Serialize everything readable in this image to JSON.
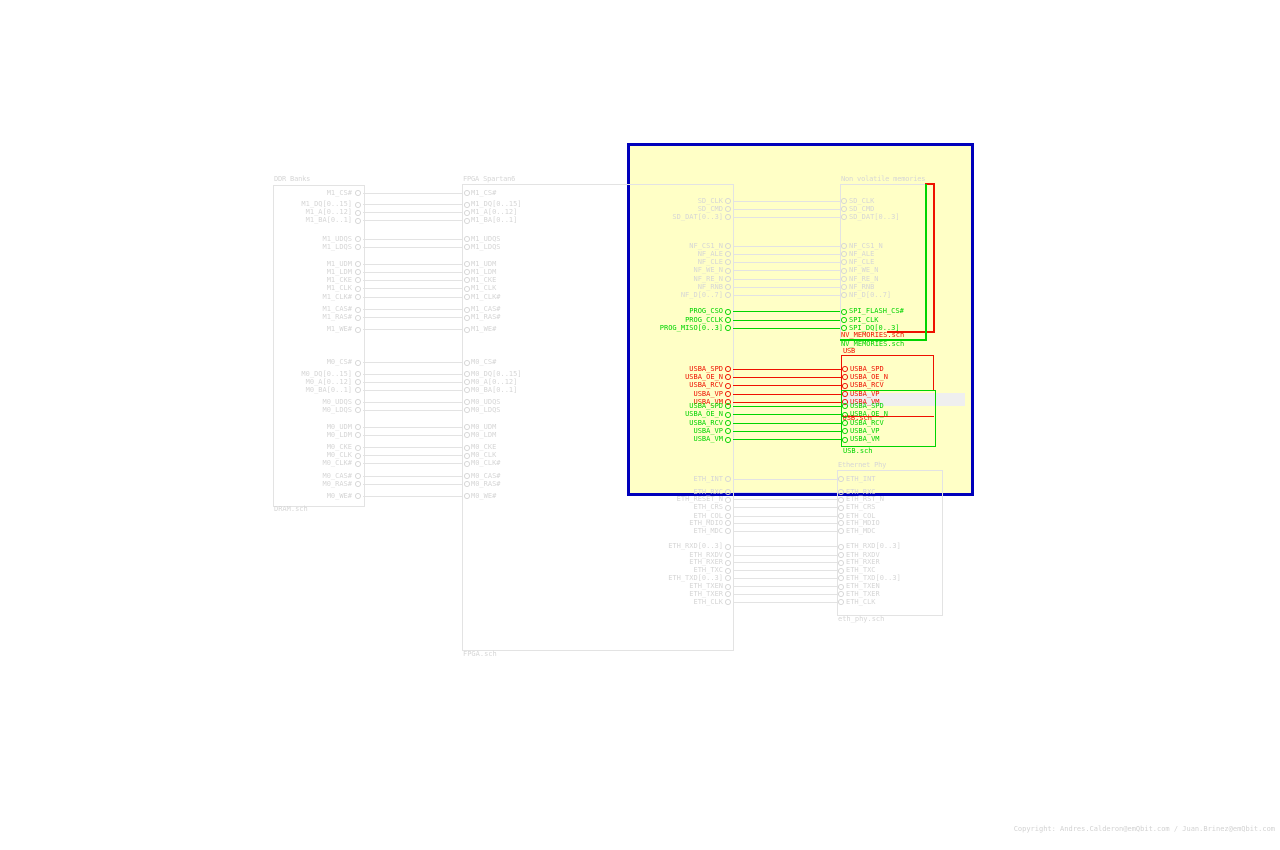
{
  "app": {
    "copyright": "Copyright: Andres.Calderon@emQbit.com  /  Juan.Brinez@emQbit.com"
  },
  "colors": {
    "background": "#ffffff",
    "inactive_text": "#d6d6d6",
    "inactive_line": "#e3e3e3",
    "selected_green": "#00d400",
    "ghost_red": "#ee1100",
    "selection_fill": "#ffffc6",
    "selection_border": "#0000bb",
    "artifact_fill": "#efefef",
    "copyright_text": "#d2d2d2"
  },
  "sheets": [
    {
      "id": "dram",
      "title": "DDR Banks",
      "file": "DRAM.sch",
      "color": "gray"
    },
    {
      "id": "fpga",
      "title": "FPGA Spartan6",
      "file": "FPGA.sch",
      "color": "gray"
    },
    {
      "id": "nv",
      "title": "Non volatile memories",
      "file": "",
      "color": "gray"
    },
    {
      "id": "eth",
      "title": "Ethernet Phy",
      "file": "eth_phy.sch",
      "color": "gray"
    },
    {
      "id": "usb_red",
      "title": "USB",
      "file": "USB.sch",
      "color": "red"
    },
    {
      "id": "usb_green",
      "title": "",
      "file": "USB.sch",
      "color": "green"
    }
  ],
  "floating_labels": [
    {
      "text": "NV_MEMORIES.sch",
      "color": "red",
      "x": 841,
      "y": 332
    },
    {
      "text": "NV_MEMORIES.sch",
      "color": "green",
      "x": 841,
      "y": 341
    }
  ],
  "nets": [
    {
      "g": "a",
      "c": "gray",
      "l": "M1_CS#",
      "y": 193.3
    },
    {
      "g": "a",
      "c": "gray",
      "l": "M1_DQ[0..15]",
      "y": 204.5
    },
    {
      "g": "a",
      "c": "gray",
      "l": "M1_A[0..12]",
      "y": 212.5
    },
    {
      "g": "a",
      "c": "gray",
      "l": "M1_BA[0..1]",
      "y": 220.5
    },
    {
      "g": "a",
      "c": "gray",
      "l": "M1_UDQS",
      "y": 239
    },
    {
      "g": "a",
      "c": "gray",
      "l": "M1_LDQS",
      "y": 247
    },
    {
      "g": "a",
      "c": "gray",
      "l": "M1_UDM",
      "y": 264.3
    },
    {
      "g": "a",
      "c": "gray",
      "l": "M1_LDM",
      "y": 272.3
    },
    {
      "g": "a",
      "c": "gray",
      "l": "M1_CKE",
      "y": 280.3
    },
    {
      "g": "a",
      "c": "gray",
      "l": "M1_CLK",
      "y": 288.7
    },
    {
      "g": "a",
      "c": "gray",
      "l": "M1_CLK#",
      "y": 297
    },
    {
      "g": "a",
      "c": "gray",
      "l": "M1_CAS#",
      "y": 309.7
    },
    {
      "g": "a",
      "c": "gray",
      "l": "M1_RAS#",
      "y": 317.7
    },
    {
      "g": "a",
      "c": "gray",
      "l": "M1_WE#",
      "y": 329.7
    },
    {
      "g": "a",
      "c": "gray",
      "l": "M0_CS#",
      "y": 362.7
    },
    {
      "g": "a",
      "c": "gray",
      "l": "M0_DQ[0..15]",
      "y": 374.3
    },
    {
      "g": "a",
      "c": "gray",
      "l": "M0_A[0..12]",
      "y": 382.3
    },
    {
      "g": "a",
      "c": "gray",
      "l": "M0_BA[0..1]",
      "y": 390.3
    },
    {
      "g": "a",
      "c": "gray",
      "l": "M0_UDQS",
      "y": 402.3
    },
    {
      "g": "a",
      "c": "gray",
      "l": "M0_LDQS",
      "y": 410.3
    },
    {
      "g": "a",
      "c": "gray",
      "l": "M0_UDM",
      "y": 427.3
    },
    {
      "g": "a",
      "c": "gray",
      "l": "M0_LDM",
      "y": 435.3
    },
    {
      "g": "a",
      "c": "gray",
      "l": "M0_CKE",
      "y": 447.7
    },
    {
      "g": "a",
      "c": "gray",
      "l": "M0_CLK",
      "y": 455.7
    },
    {
      "g": "a",
      "c": "gray",
      "l": "M0_CLK#",
      "y": 463.7
    },
    {
      "g": "a",
      "c": "gray",
      "l": "M0_CAS#",
      "y": 476
    },
    {
      "g": "a",
      "c": "gray",
      "l": "M0_RAS#",
      "y": 484
    },
    {
      "g": "a",
      "c": "gray",
      "l": "M0_WE#",
      "y": 496
    },
    {
      "g": "b",
      "c": "gray",
      "l": "SD_CLK",
      "y": 201
    },
    {
      "g": "b",
      "c": "gray",
      "l": "SD_CMD",
      "y": 209.3
    },
    {
      "g": "b",
      "c": "gray",
      "l": "SD_DAT[0..3]",
      "y": 217.3
    },
    {
      "g": "b",
      "c": "gray",
      "l": "NF_CS1_N",
      "y": 246
    },
    {
      "g": "b",
      "c": "gray",
      "l": "NF_ALE",
      "y": 254
    },
    {
      "g": "b",
      "c": "gray",
      "l": "NF_CLE",
      "y": 262.3
    },
    {
      "g": "b",
      "c": "gray",
      "l": "NF_WE_N",
      "y": 270.7
    },
    {
      "g": "b",
      "c": "gray",
      "l": "NF_RE_N",
      "y": 279
    },
    {
      "g": "b",
      "c": "gray",
      "l": "NF_RNB",
      "y": 287
    },
    {
      "g": "b",
      "c": "gray",
      "l": "NF_D[0..7]",
      "y": 295.3
    },
    {
      "g": "b",
      "c": "green",
      "l": "PROG_CSO",
      "r": "SPI_FLASH_CS#",
      "y": 311.7
    },
    {
      "g": "b",
      "c": "green",
      "l": "PROG_CCLK",
      "r": "SPI_CLK",
      "y": 320
    },
    {
      "g": "b",
      "c": "green",
      "l": "PROG_MISO[0..3]",
      "r": "SPI_DQ[0..3]",
      "y": 328.3
    },
    {
      "g": "c",
      "c": "red",
      "l": "USBA_SPD",
      "y": 369
    },
    {
      "g": "c",
      "c": "red",
      "l": "USBA_OE_N",
      "y": 377.3
    },
    {
      "g": "c",
      "c": "red",
      "l": "USBA_RCV",
      "y": 385.7
    },
    {
      "g": "c",
      "c": "red",
      "l": "USBA_VP",
      "y": 394
    },
    {
      "g": "c",
      "c": "red",
      "l": "USBA_VM",
      "y": 402.3
    },
    {
      "g": "d",
      "c": "green",
      "l": "USBA_SPD",
      "y": 406
    },
    {
      "g": "d",
      "c": "green",
      "l": "USBA_OE_N",
      "y": 414.7
    },
    {
      "g": "d",
      "c": "green",
      "l": "USBA_RCV",
      "y": 423
    },
    {
      "g": "d",
      "c": "green",
      "l": "USBA_VP",
      "y": 431.3
    },
    {
      "g": "d",
      "c": "green",
      "l": "USBA_VM",
      "y": 439.7
    },
    {
      "g": "e",
      "c": "gray",
      "l": "ETH_INT",
      "y": 479
    },
    {
      "g": "e",
      "c": "gray",
      "l": "ETH_RXC",
      "y": 492
    },
    {
      "g": "e",
      "c": "gray",
      "l": "ETH_RESET_N",
      "r": "ETH_RST_N",
      "y": 499.7
    },
    {
      "g": "e",
      "c": "gray",
      "l": "ETH_CRS",
      "y": 507.7
    },
    {
      "g": "e",
      "c": "gray",
      "l": "ETH_COL",
      "y": 516
    },
    {
      "g": "e",
      "c": "gray",
      "l": "ETH_MDIO",
      "y": 523.3
    },
    {
      "g": "e",
      "c": "gray",
      "l": "ETH_MDC",
      "y": 531
    },
    {
      "g": "e",
      "c": "gray",
      "l": "ETH_RXD[0..3]",
      "y": 546.7
    },
    {
      "g": "e",
      "c": "gray",
      "l": "ETH_RXDV",
      "y": 555
    },
    {
      "g": "e",
      "c": "gray",
      "l": "ETH_RXER",
      "y": 562.7
    },
    {
      "g": "e",
      "c": "gray",
      "l": "ETH_TXC",
      "y": 570.7
    },
    {
      "g": "e",
      "c": "gray",
      "l": "ETH_TXD[0..3]",
      "y": 578.3
    },
    {
      "g": "e",
      "c": "gray",
      "l": "ETH_TXEN",
      "y": 586.7
    },
    {
      "g": "e",
      "c": "gray",
      "l": "ETH_TXER",
      "y": 594.3
    },
    {
      "g": "e",
      "c": "gray",
      "l": "ETH_CLK",
      "y": 602.3
    }
  ],
  "ghost_segments": [
    {
      "color": "red",
      "x": 925,
      "y": 183,
      "w": 10,
      "h": 2
    },
    {
      "color": "red",
      "x": 933,
      "y": 183,
      "w": 2,
      "h": 149
    },
    {
      "color": "red",
      "x": 887,
      "y": 331,
      "w": 48,
      "h": 2
    },
    {
      "color": "red",
      "x": 932.5,
      "y": 355,
      "w": 1.5,
      "h": 35
    },
    {
      "color": "green",
      "x": 925,
      "y": 184,
      "w": 2,
      "h": 156
    },
    {
      "color": "green",
      "x": 840,
      "y": 339,
      "w": 87,
      "h": 2
    }
  ],
  "overlays": {
    "selection": {
      "x": 627,
      "y": 143,
      "w": 347,
      "h": 353
    },
    "artifact": {
      "x": 841,
      "y": 393,
      "w": 124,
      "h": 12.5
    }
  }
}
